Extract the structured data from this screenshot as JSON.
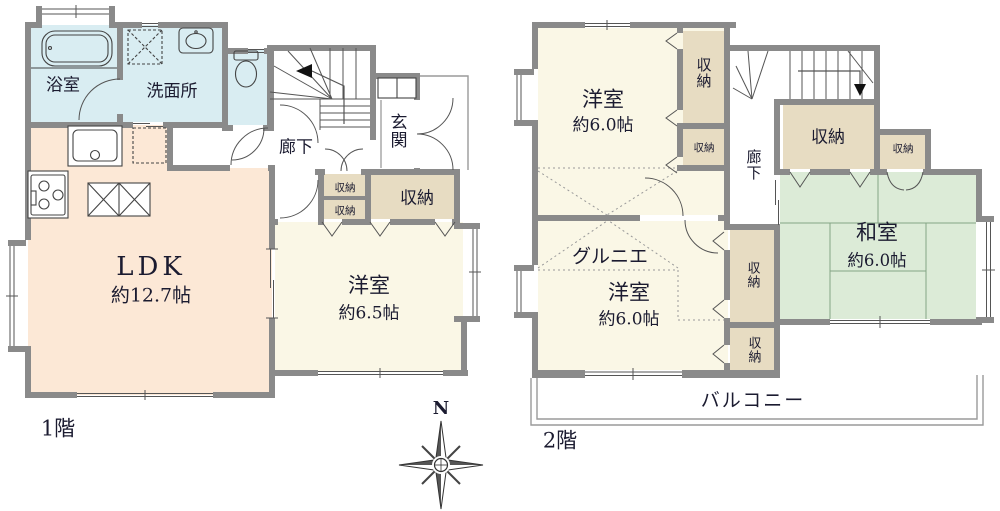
{
  "shared": {
    "storage": "収納"
  },
  "floor1": {
    "label": "1階",
    "bath": "浴室",
    "washroom": "洗面所",
    "hallway": "廊下",
    "entrance": "玄関",
    "ldk": {
      "name": "LDK",
      "size": "約12.7帖"
    },
    "western": {
      "name": "洋室",
      "size": "約6.5帖"
    }
  },
  "floor2": {
    "label": "2階",
    "western_top": {
      "name": "洋室",
      "size": "約6.0帖"
    },
    "western_bottom": {
      "name": "洋室",
      "size": "約6.0帖"
    },
    "japanese": {
      "name": "和室",
      "size": "約6.0帖"
    },
    "grenier": "グルニエ",
    "hallway": "廊下",
    "balcony": "バルコニー"
  },
  "compass": {
    "north": "N"
  },
  "colors": {
    "wall": "#8a8a8a",
    "wet_area": "#d9edf2",
    "ldk": "#fce8d6",
    "western_room": "#faf7e6",
    "storage": "#e7dcc2",
    "tatami": "#dcebd7",
    "balcony_line": "#9a9a9a"
  }
}
